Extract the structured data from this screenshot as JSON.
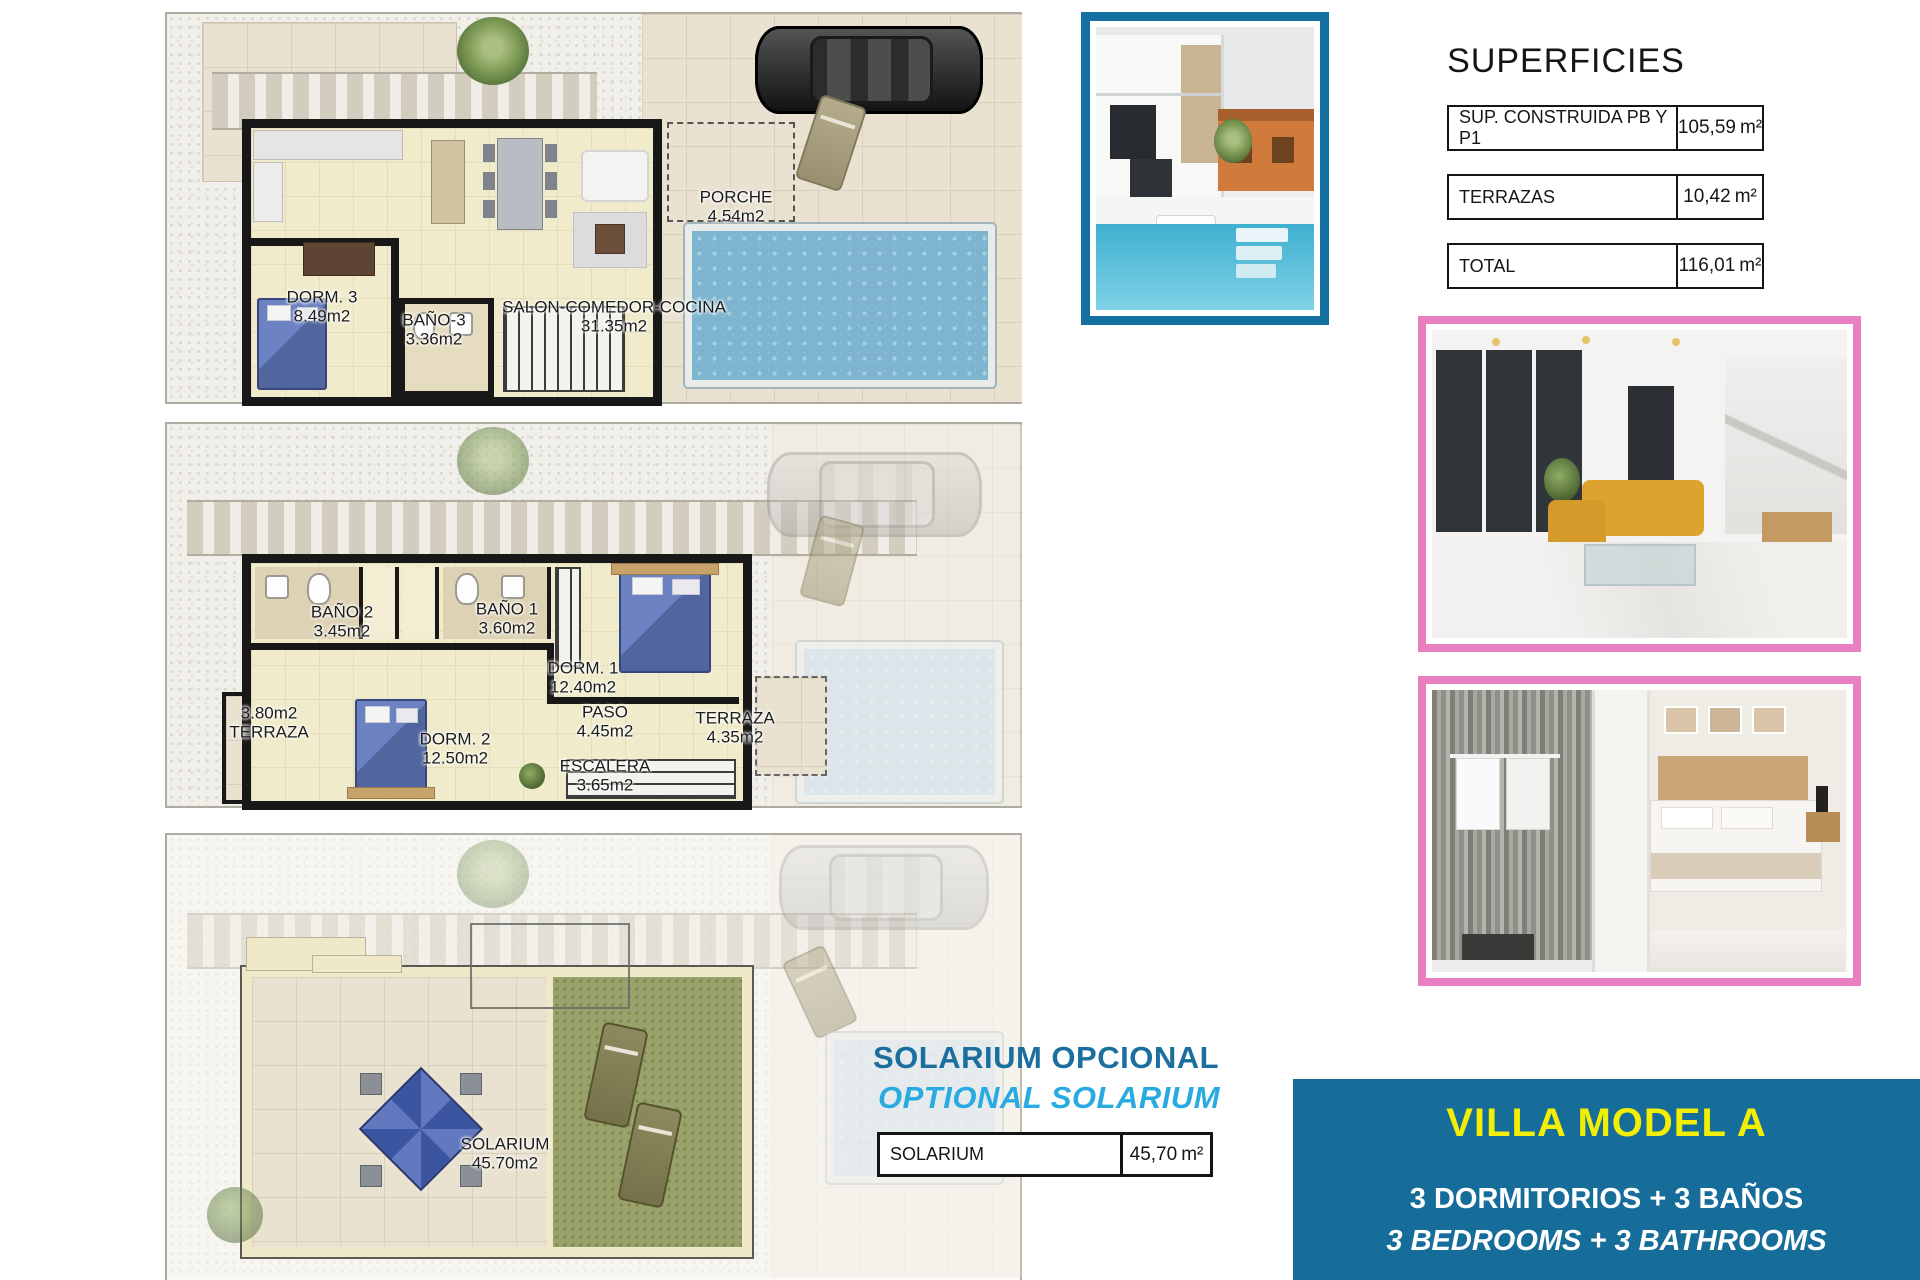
{
  "superficies": {
    "title": "SUPERFICIES",
    "rows": [
      {
        "label": "SUP. CONSTRUIDA PB Y P1",
        "value": "105,59",
        "unit": "m²"
      },
      {
        "label": "TERRAZAS",
        "value": "10,42",
        "unit": "m²"
      },
      {
        "label": "TOTAL",
        "value": "116,01",
        "unit": "m²"
      }
    ]
  },
  "solarium_section": {
    "title_es": "SOLARIUM OPCIONAL",
    "title_en": "OPTIONAL SOLARIUM",
    "table": {
      "label": "SOLARIUM",
      "value": "45,70",
      "unit": "m²"
    }
  },
  "villa_box": {
    "title": "VILLA MODEL A",
    "line_es": "3 DORMITORIOS + 3 BAÑOS",
    "line_en": "3 BEDROOMS + 3 BATHROOMS"
  },
  "floorplans": {
    "ground": {
      "labels": [
        {
          "name": "PORCHE",
          "area": "4.54m2"
        },
        {
          "name": "DORM. 3",
          "area": "8.49m2"
        },
        {
          "name": "BAÑO-3",
          "area": "3.36m2"
        },
        {
          "name": "SALON-COMEDOR-COCINA",
          "area": "31.35m2"
        }
      ]
    },
    "first": {
      "labels": [
        {
          "name": "BAÑO 2",
          "area": "3.45m2"
        },
        {
          "name": "BAÑO 1",
          "area": "3.60m2"
        },
        {
          "name": "DORM. 1",
          "area": "12.40m2"
        },
        {
          "name": "TERRAZA",
          "area": "3.80m2"
        },
        {
          "name": "DORM. 2",
          "area": "12.50m2"
        },
        {
          "name": "PASO",
          "area": "4.45m2"
        },
        {
          "name": "TERRAZA",
          "area": "4.35m2"
        },
        {
          "name": "ESCALERA",
          "area": "3.65m2"
        }
      ]
    },
    "solarium": {
      "labels": [
        {
          "name": "SOLARIUM",
          "area": "45.70m2"
        }
      ]
    }
  },
  "colors": {
    "photo_frame_teal": "#1470a0",
    "photo_frame_pink": "#e87fc0",
    "solarium_title_blue": "#1b6f9e",
    "solarium_title_lightblue": "#29abe2",
    "villa_box_blue": "#176d99",
    "villa_title_yellow": "#f2ee04",
    "pool_blue": "#7db4d0"
  }
}
